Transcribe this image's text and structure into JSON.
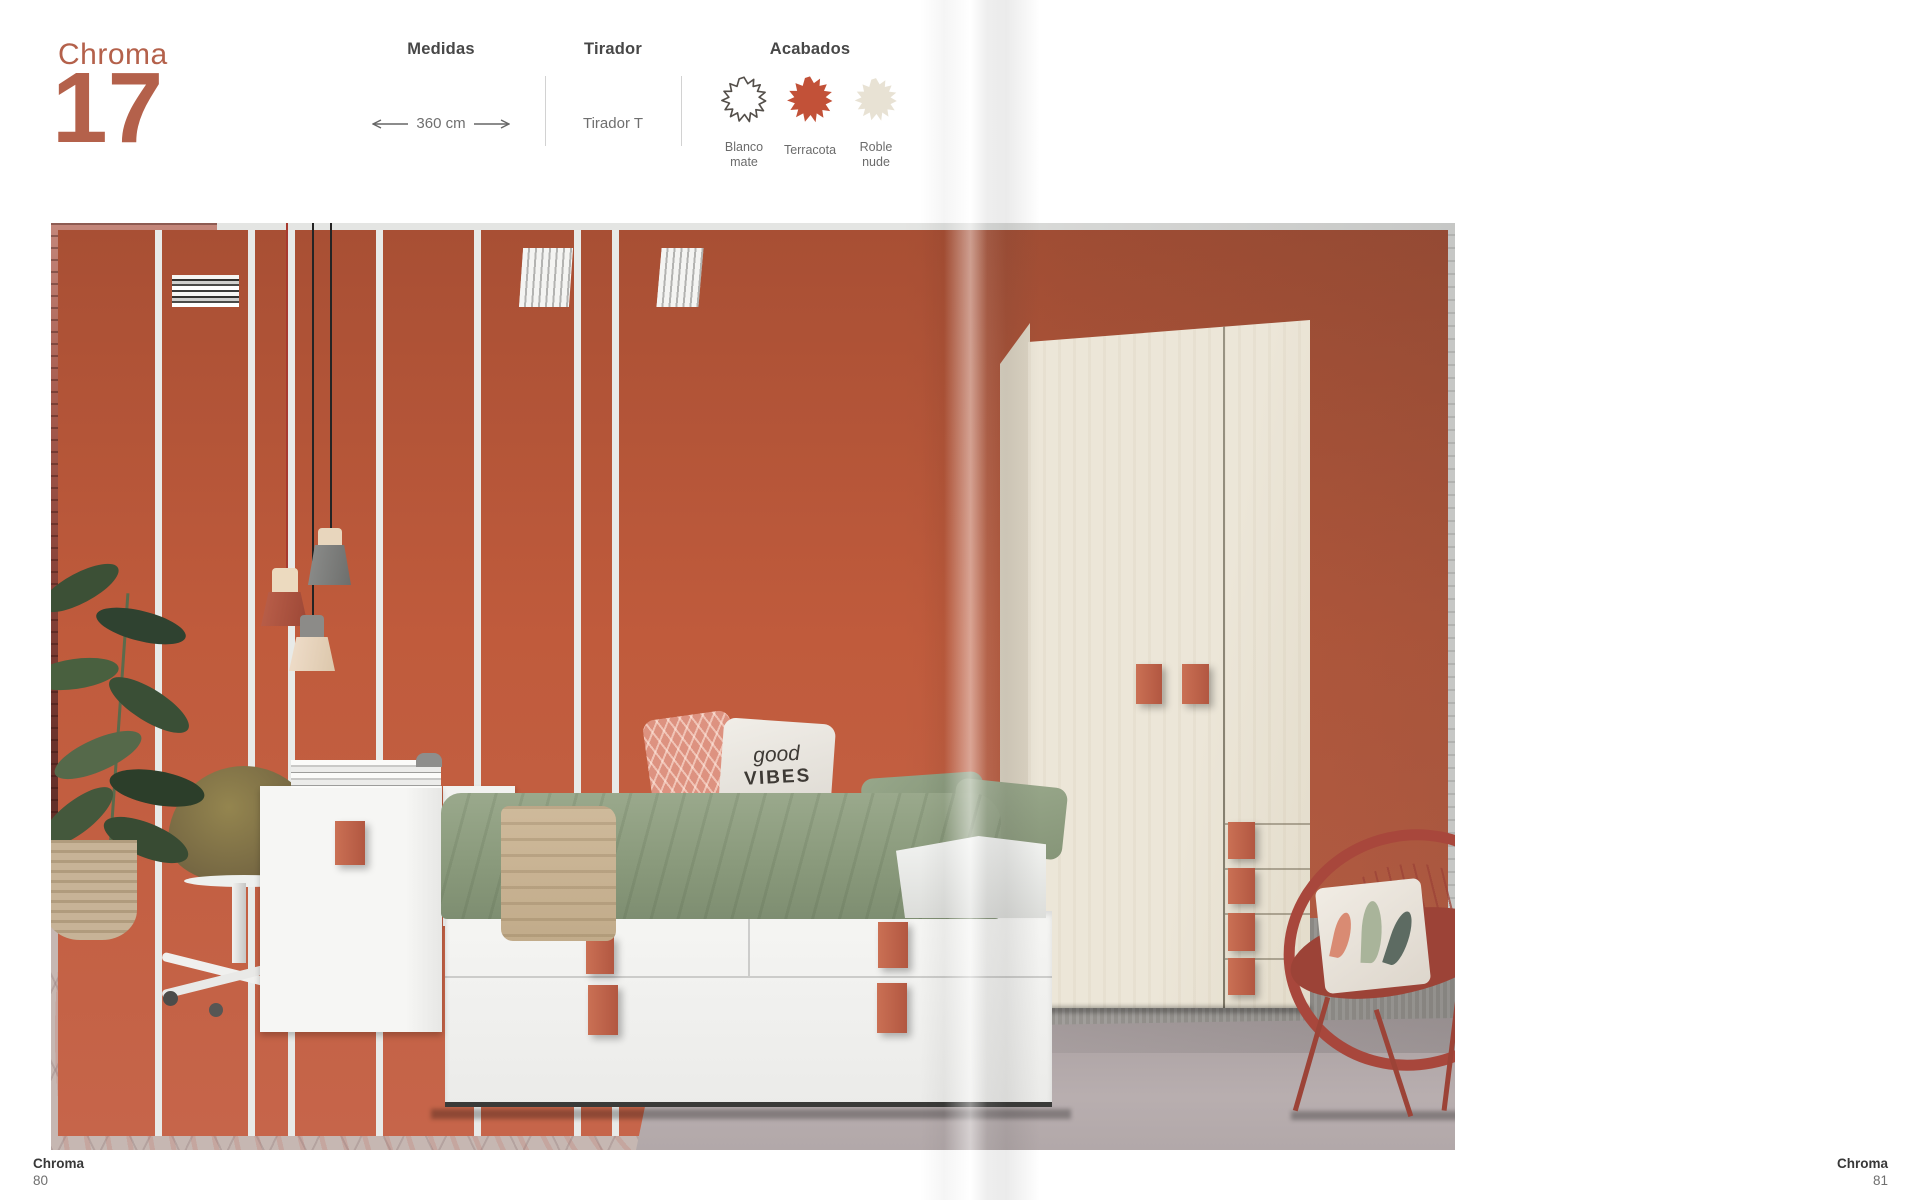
{
  "page": {
    "brand": "Chroma",
    "model_number": "17",
    "accent_color": "#b4614b"
  },
  "specs": {
    "medidas": {
      "label": "Medidas",
      "value": "360 cm"
    },
    "tirador": {
      "label": "Tirador",
      "value": "Tirador T"
    },
    "acabados": {
      "label": "Acabados",
      "finishes": [
        {
          "name": "Blanco mate",
          "line1": "Blanco",
          "line2": "mate",
          "color": "#ffffff",
          "outline": "#544f4a"
        },
        {
          "name": "Terracota",
          "line1": "Terracota",
          "line2": "",
          "color": "#c25138",
          "outline": "none"
        },
        {
          "name": "Roble nude",
          "line1": "Roble",
          "line2": "nude",
          "color": "#e8e2d4",
          "outline": "none"
        }
      ]
    }
  },
  "photo": {
    "pillow_text": {
      "line1": "good",
      "line2": "VIBES"
    },
    "palette": {
      "terracotta_handle": "#bd6149",
      "sage_bedding": "#8a9a7c",
      "roble_wood": "#ece6d8",
      "brick_red_wall": "#8a443a",
      "tile_floor": "#c6b7b2",
      "rattan_chair": "#a8473c"
    }
  },
  "footer_left": {
    "brand": "Chroma",
    "page_number": "80"
  },
  "footer_right": {
    "brand": "Chroma",
    "page_number": "81"
  }
}
